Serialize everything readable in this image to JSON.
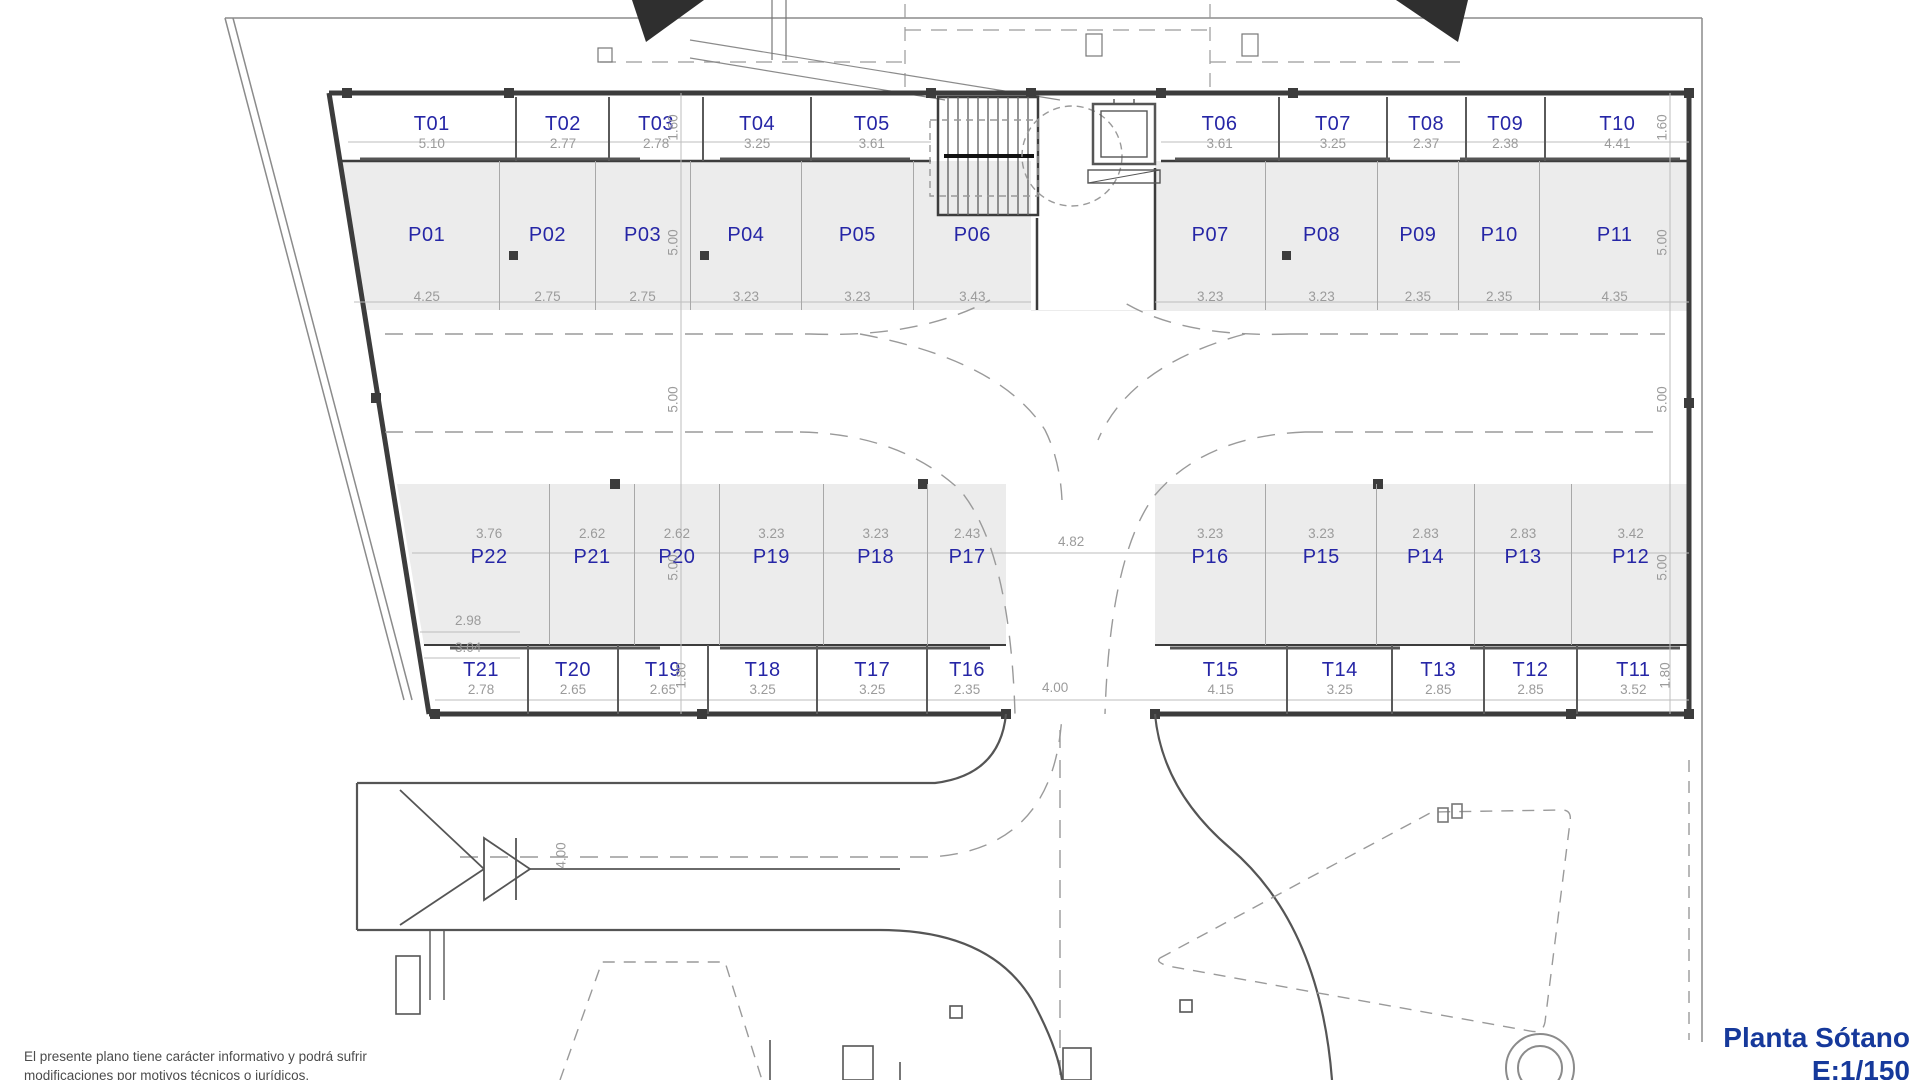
{
  "title": {
    "name": "Planta Sótano",
    "scale": "E:1/150"
  },
  "disclaimer": {
    "line1": "El  presente  plano  tiene  carácter  informativo  y  podrá  sufrir",
    "line2": "modificaciones por motivos técnicos o jurídicos."
  },
  "colors": {
    "room_label_blue": "#2626a6",
    "dimension_gray": "#9b9b9b",
    "wall_dark": "#3c3c3c",
    "parking_fill": "#ececec",
    "title_blue": "#16399b"
  },
  "rows": {
    "top_t_left": [
      {
        "label": "T01",
        "dim": "5.10"
      },
      {
        "label": "T02",
        "dim": "2.77"
      },
      {
        "label": "T03",
        "dim": "2.78"
      },
      {
        "label": "T04",
        "dim": "3.25"
      },
      {
        "label": "T05",
        "dim": "3.61"
      }
    ],
    "top_t_right": [
      {
        "label": "T06",
        "dim": "3.61"
      },
      {
        "label": "T07",
        "dim": "3.25"
      },
      {
        "label": "T08",
        "dim": "2.37"
      },
      {
        "label": "T09",
        "dim": "2.38"
      },
      {
        "label": "T10",
        "dim": "4.41"
      }
    ],
    "top_p_left": [
      {
        "label": "P01",
        "dim": "4.25"
      },
      {
        "label": "P02",
        "dim": "2.75"
      },
      {
        "label": "P03",
        "dim": "2.75"
      },
      {
        "label": "P04",
        "dim": "3.23"
      },
      {
        "label": "P05",
        "dim": "3.23"
      },
      {
        "label": "P06",
        "dim": "3.43"
      }
    ],
    "top_p_right": [
      {
        "label": "P07",
        "dim": "3.23"
      },
      {
        "label": "P08",
        "dim": "3.23"
      },
      {
        "label": "P09",
        "dim": "2.35"
      },
      {
        "label": "P10",
        "dim": "2.35"
      },
      {
        "label": "P11",
        "dim": "4.35"
      }
    ],
    "bottom_p_left": [
      {
        "label": "P22",
        "dim": "3.76"
      },
      {
        "label": "P21",
        "dim": "2.62"
      },
      {
        "label": "P20",
        "dim": "2.62"
      },
      {
        "label": "P19",
        "dim": "3.23"
      },
      {
        "label": "P18",
        "dim": "3.23"
      },
      {
        "label": "P17",
        "dim": "2.43"
      }
    ],
    "bottom_p_right": [
      {
        "label": "P16",
        "dim": "3.23"
      },
      {
        "label": "P15",
        "dim": "3.23"
      },
      {
        "label": "P14",
        "dim": "2.83"
      },
      {
        "label": "P13",
        "dim": "2.83"
      },
      {
        "label": "P12",
        "dim": "3.42"
      }
    ],
    "bottom_t_left": [
      {
        "label": "T21",
        "dim": "2.78"
      },
      {
        "label": "T20",
        "dim": "2.65"
      },
      {
        "label": "T19",
        "dim": "2.65"
      },
      {
        "label": "T18",
        "dim": "3.25"
      },
      {
        "label": "T17",
        "dim": "3.25"
      },
      {
        "label": "T16",
        "dim": "2.35"
      }
    ],
    "bottom_t_right": [
      {
        "label": "T15",
        "dim": "4.15"
      },
      {
        "label": "T14",
        "dim": "3.25"
      },
      {
        "label": "T13",
        "dim": "2.85"
      },
      {
        "label": "T12",
        "dim": "2.85"
      },
      {
        "label": "T11",
        "dim": "3.52"
      }
    ]
  },
  "dims": {
    "t_top_depth": "1.60",
    "p_depth": "5.00",
    "t_bottom_depth": "1.80",
    "aisle_width": "4.82",
    "lane_width": "4.00",
    "ramp_width": "4.00",
    "p22_sub1": "2.98",
    "p22_sub2": "3.04"
  }
}
